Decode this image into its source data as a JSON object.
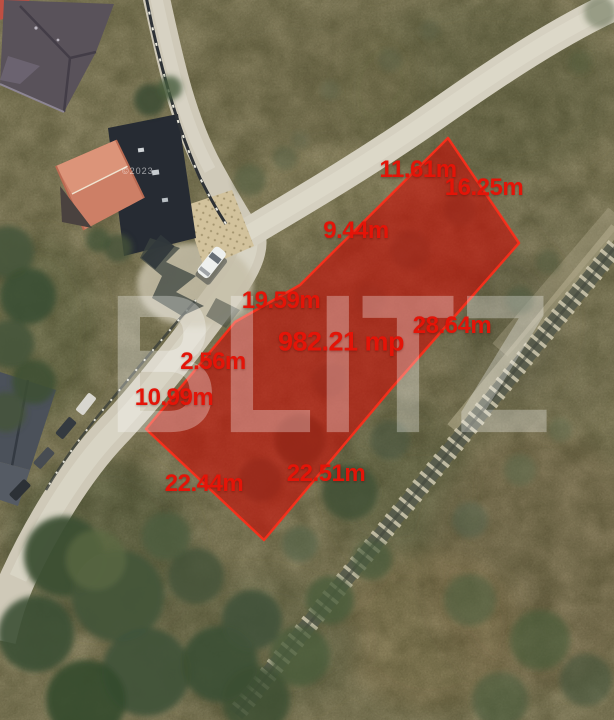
{
  "watermark": {
    "brand": "BLITZ",
    "credit": "©2023"
  },
  "plot_overlay": {
    "area": {
      "text": "982.21 mp"
    },
    "measurements": [
      {
        "side": "road-side-top",
        "text": "11.61m"
      },
      {
        "side": "northeast-end",
        "text": "16.25m"
      },
      {
        "side": "road-side-upper",
        "text": "9.44m"
      },
      {
        "side": "road-side-middle",
        "text": "19.59m"
      },
      {
        "side": "southeast-upper",
        "text": "28.64m"
      },
      {
        "side": "road-side-lower",
        "text": "2.56m"
      },
      {
        "side": "road-side-west-end",
        "text": "10.99m"
      },
      {
        "side": "southwest-end",
        "text": "22.44m"
      },
      {
        "side": "southeast-lower",
        "text": "22.51m"
      }
    ],
    "colors": {
      "fill": "#c60d05",
      "stroke": "#ff2d1a",
      "label": "#e41408"
    }
  }
}
